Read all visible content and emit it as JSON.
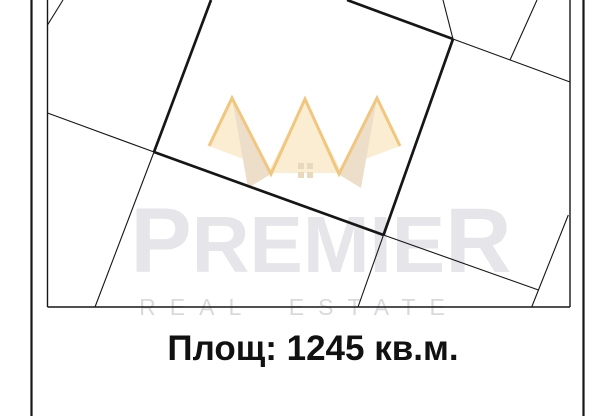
{
  "page": {
    "bg": "#ffffff",
    "line_color": "#161616"
  },
  "outer_frame": {
    "lines": [
      [
        31.5,
        0,
        31.5,
        416
      ],
      [
        583.5,
        0,
        583.5,
        416
      ]
    ]
  },
  "map": {
    "border_lines": [
      [
        47.5,
        0,
        47.5,
        307
      ],
      [
        47.5,
        307,
        570,
        307
      ],
      [
        570,
        0,
        570,
        307
      ]
    ],
    "parcel_thick_lines": [
      [
        211,
        0,
        154,
        152
      ],
      [
        154,
        152,
        383.5,
        235
      ],
      [
        453,
        39,
        383.5,
        235
      ],
      [
        347,
        0,
        453,
        39
      ]
    ],
    "thin_lines": [
      [
        154,
        152,
        95,
        307
      ],
      [
        47.5,
        113,
        154,
        152
      ],
      [
        383.5,
        235,
        538.5,
        290
      ],
      [
        383.5,
        235,
        358,
        307
      ],
      [
        453,
        39,
        570,
        82
      ],
      [
        510,
        60,
        537,
        0
      ],
      [
        443,
        0,
        453,
        39
      ],
      [
        568.3,
        215,
        531.7,
        307
      ],
      [
        63,
        0,
        47.5,
        25
      ]
    ]
  },
  "watermark": {
    "brand_initial": "P",
    "brand_middle": "REMIE",
    "brand_final": "R",
    "tagline": "REAL ESTATE",
    "brand_color": "#e6e5e9",
    "tagline_color": "#d9d9dd",
    "crown": {
      "light": "#fbe9c6",
      "gold": "#eeb95e",
      "tan": "#e9d6bc",
      "window": "#e2cfae"
    }
  },
  "caption": {
    "area_label": "Площ: 1245 кв.м."
  }
}
